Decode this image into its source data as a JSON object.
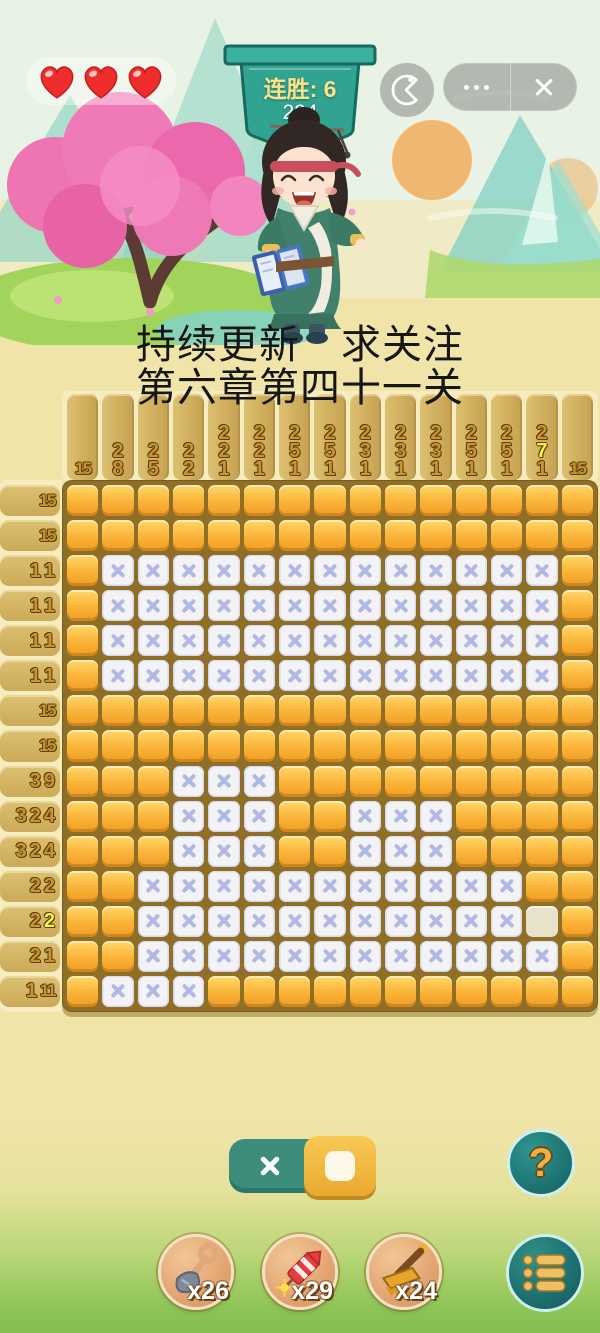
{
  "hud": {
    "hearts_count": 3,
    "streak_label": "连胜: 6",
    "streak_value": "224"
  },
  "promo": {
    "line1": "持续更新　求关注",
    "line2": "第六章第四十一关"
  },
  "puzzle": {
    "size": 15,
    "col_clues": [
      [
        "15"
      ],
      [
        "2",
        "8"
      ],
      [
        "2",
        "5"
      ],
      [
        "2",
        "2"
      ],
      [
        "2",
        "2",
        "1"
      ],
      [
        "2",
        "2",
        "1"
      ],
      [
        "2",
        "5",
        "1"
      ],
      [
        "2",
        "5",
        "1"
      ],
      [
        "2",
        "3",
        "1"
      ],
      [
        "2",
        "3",
        "1"
      ],
      [
        "2",
        "3",
        "1"
      ],
      [
        "2",
        "5",
        "1"
      ],
      [
        "2",
        "5",
        "1"
      ],
      [
        "2",
        "7*",
        "1"
      ],
      [
        "15"
      ]
    ],
    "row_clues": [
      [
        "15"
      ],
      [
        "15"
      ],
      [
        "1",
        "1"
      ],
      [
        "1",
        "1"
      ],
      [
        "1",
        "1"
      ],
      [
        "1",
        "1"
      ],
      [
        "15"
      ],
      [
        "15"
      ],
      [
        "3",
        "9"
      ],
      [
        "3",
        "2",
        "4"
      ],
      [
        "3",
        "2",
        "4"
      ],
      [
        "2",
        "2"
      ],
      [
        "2",
        "2*"
      ],
      [
        "2",
        "1"
      ],
      [
        "1",
        "11"
      ]
    ],
    "grid": [
      "FFFFFFFFFFFFFFF",
      "FFFFFFFFFFFFFFF",
      "FXXXXXXXXXXXXXF",
      "FXXXXXXXXXXXXXF",
      "FXXXXXXXXXXXXXF",
      "FXXXXXXXXXXXXXF",
      "FFFFFFFFFFFFFFF",
      "FFFFFFFFFFFFFFF",
      "FFFXXXFFFFFFFFF",
      "FFFXXXFFXXXFFFF",
      "FFFXXXFFXXXFFFF",
      "FFXXXXXXXXXXXFF",
      "FFXXXXXXXXXXXEF",
      "FFXXXXXXXXXXXXF",
      "FXXXFFFFFFFFFFF"
    ]
  },
  "controls": {
    "help_label": "?",
    "tools": [
      {
        "name": "shovel",
        "count": "x26"
      },
      {
        "name": "firecracker",
        "count": "x29"
      },
      {
        "name": "rake",
        "count": "x24"
      }
    ]
  },
  "colors": {
    "accent_teal": "#2e8d80",
    "cell_gold": "#fab337",
    "x_mark": "#b2b8e4",
    "clue_gold": "#c99530",
    "clue_highlight": "#f6f441",
    "board_back": "#8f6f26"
  }
}
